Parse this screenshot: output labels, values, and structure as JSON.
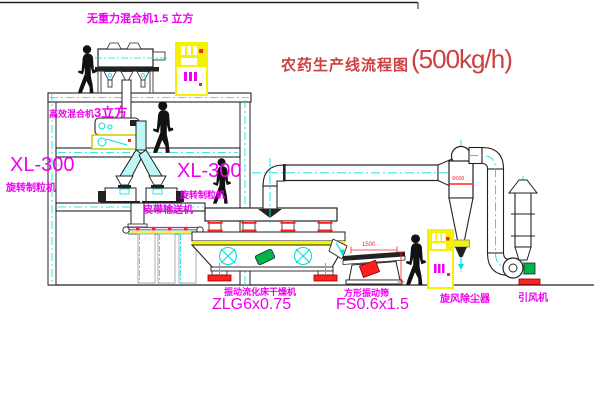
{
  "title": {
    "main": "农药生产线流程图",
    "capacity": "(500kg/h)"
  },
  "labels": {
    "gravity_mixer": "无重力混合机1.5 立方",
    "high_mixer_name": "高效混合机",
    "high_mixer_size": "3立方",
    "granulator_model_left": "XL-300",
    "granulator_name_left": "旋转制粒机",
    "granulator_model_right": "XL-300",
    "granulator_name_right": "旋转制粒机",
    "belt_conveyor": "皮带输送机",
    "dryer_name": "振动流化床干燥机",
    "dryer_model": "ZLG6x0.75",
    "sieve_name": "方形振动筛",
    "sieve_model": "FS0.6x1.5",
    "cyclone": "旋风除尘器",
    "fan": "引风机"
  },
  "dimensions": {
    "sieve_width": "1500",
    "cyclone_diameter": "Φ600"
  },
  "colors": {
    "label_magenta": "#f000f0",
    "title_red": "#cc4040",
    "accent_red": "#ff2020",
    "equipment_yellow": "#f3f300",
    "centerline_cyan": "#00e0e0",
    "motor_green": "#00b44c",
    "line_black": "#222222"
  }
}
